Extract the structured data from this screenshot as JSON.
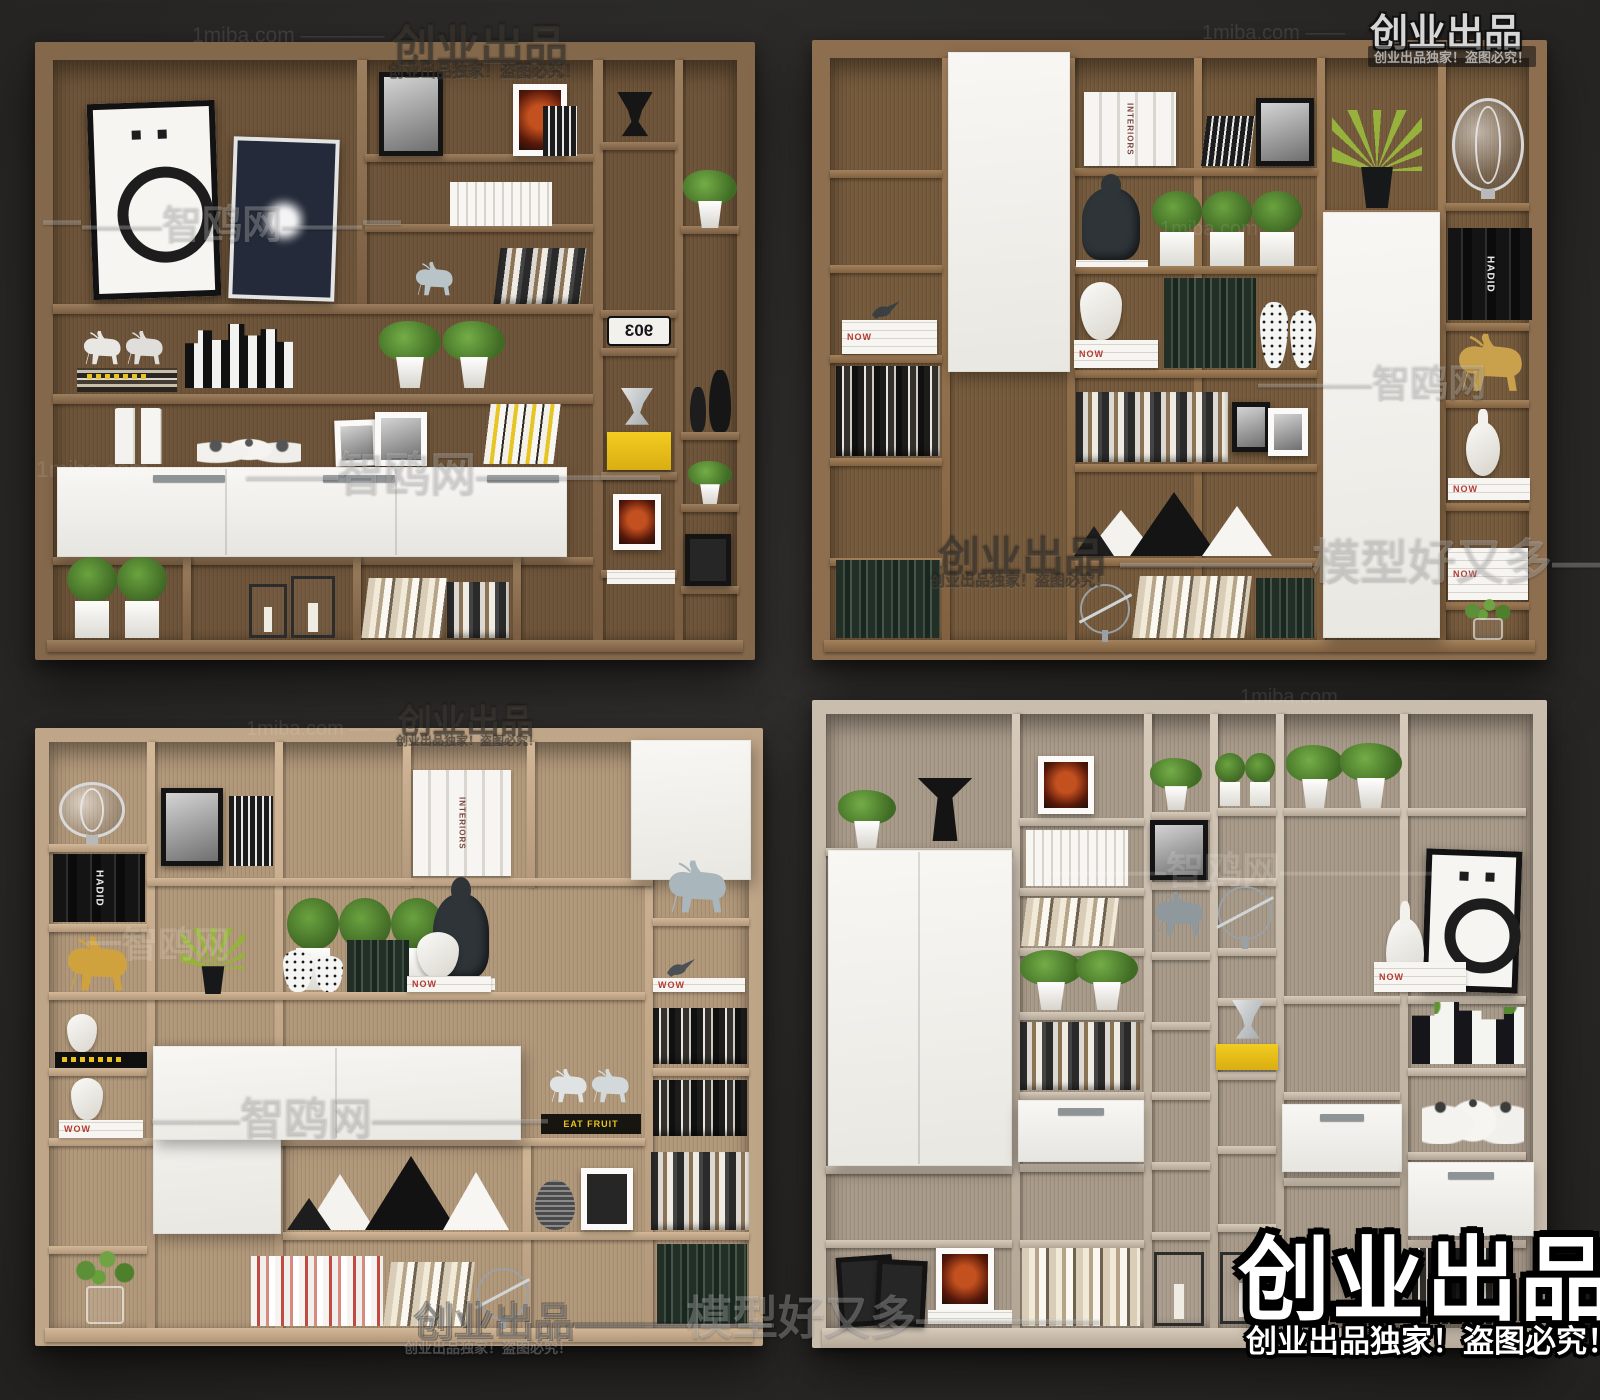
{
  "image_type": "3d-furniture-model-catalog-render",
  "palette": {
    "background": "#2b2a28",
    "wood_dark_walnut": "#7c6045",
    "wood_medium_walnut": "#8a6b4c",
    "wood_light_oak": "#b99e80",
    "wood_pale_grey_oak": "#c8bcac",
    "white_panel": "#f4f3ef",
    "accent_yellow": "#e9c41d",
    "plant_green": "#5e8f3a"
  },
  "panels": [
    {
      "name": "bookcase-dark-walnut",
      "position": "top-left"
    },
    {
      "name": "bookcase-walnut-white-doors",
      "position": "top-right"
    },
    {
      "name": "bookcase-light-oak",
      "position": "bottom-left"
    },
    {
      "name": "bookcase-pale-grey-oak",
      "position": "bottom-right"
    }
  ],
  "labels": {
    "interiors": "INTERIORS",
    "hadid": "HADID",
    "now": "NOW",
    "wow": "WOW",
    "eat_fruit": "EAT FRUIT",
    "sign_903": "903"
  },
  "watermarks": [
    {
      "t": "1miba.com ————"
    },
    {
      "t": "创业出品",
      "s": "创业出品独家！盗图必究！"
    },
    {
      "t": "1miba.com ——"
    },
    {
      "t": "创业出品",
      "s": "创业出品独家！盗图必究！"
    },
    {
      "t": "一——智鸥网——一"
    },
    {
      "t": "1miba.com"
    },
    {
      "t": "——智鸥网————"
    },
    {
      "t": "1miba.com"
    },
    {
      "t": "———智鸥网"
    },
    {
      "t": "创业出品",
      "s": "创业出品独家！盗图必究！"
    },
    {
      "t": "————模型好又多——"
    },
    {
      "t": "1miba.com — —"
    },
    {
      "t": "创业出品",
      "s": "创业出品独家！盗图必究！"
    },
    {
      "t": "一智鸥网"
    },
    {
      "t": "——智鸥网————"
    },
    {
      "t": "创业出品—————",
      "s": "创业出品独家！盗图必究！"
    },
    {
      "t": "模型好又多————"
    },
    {
      "t": "———智鸥网————"
    },
    {
      "t": "1miba.com"
    },
    {
      "t": "创业出品",
      "s": "创业出品独家！盗图必究！"
    }
  ]
}
